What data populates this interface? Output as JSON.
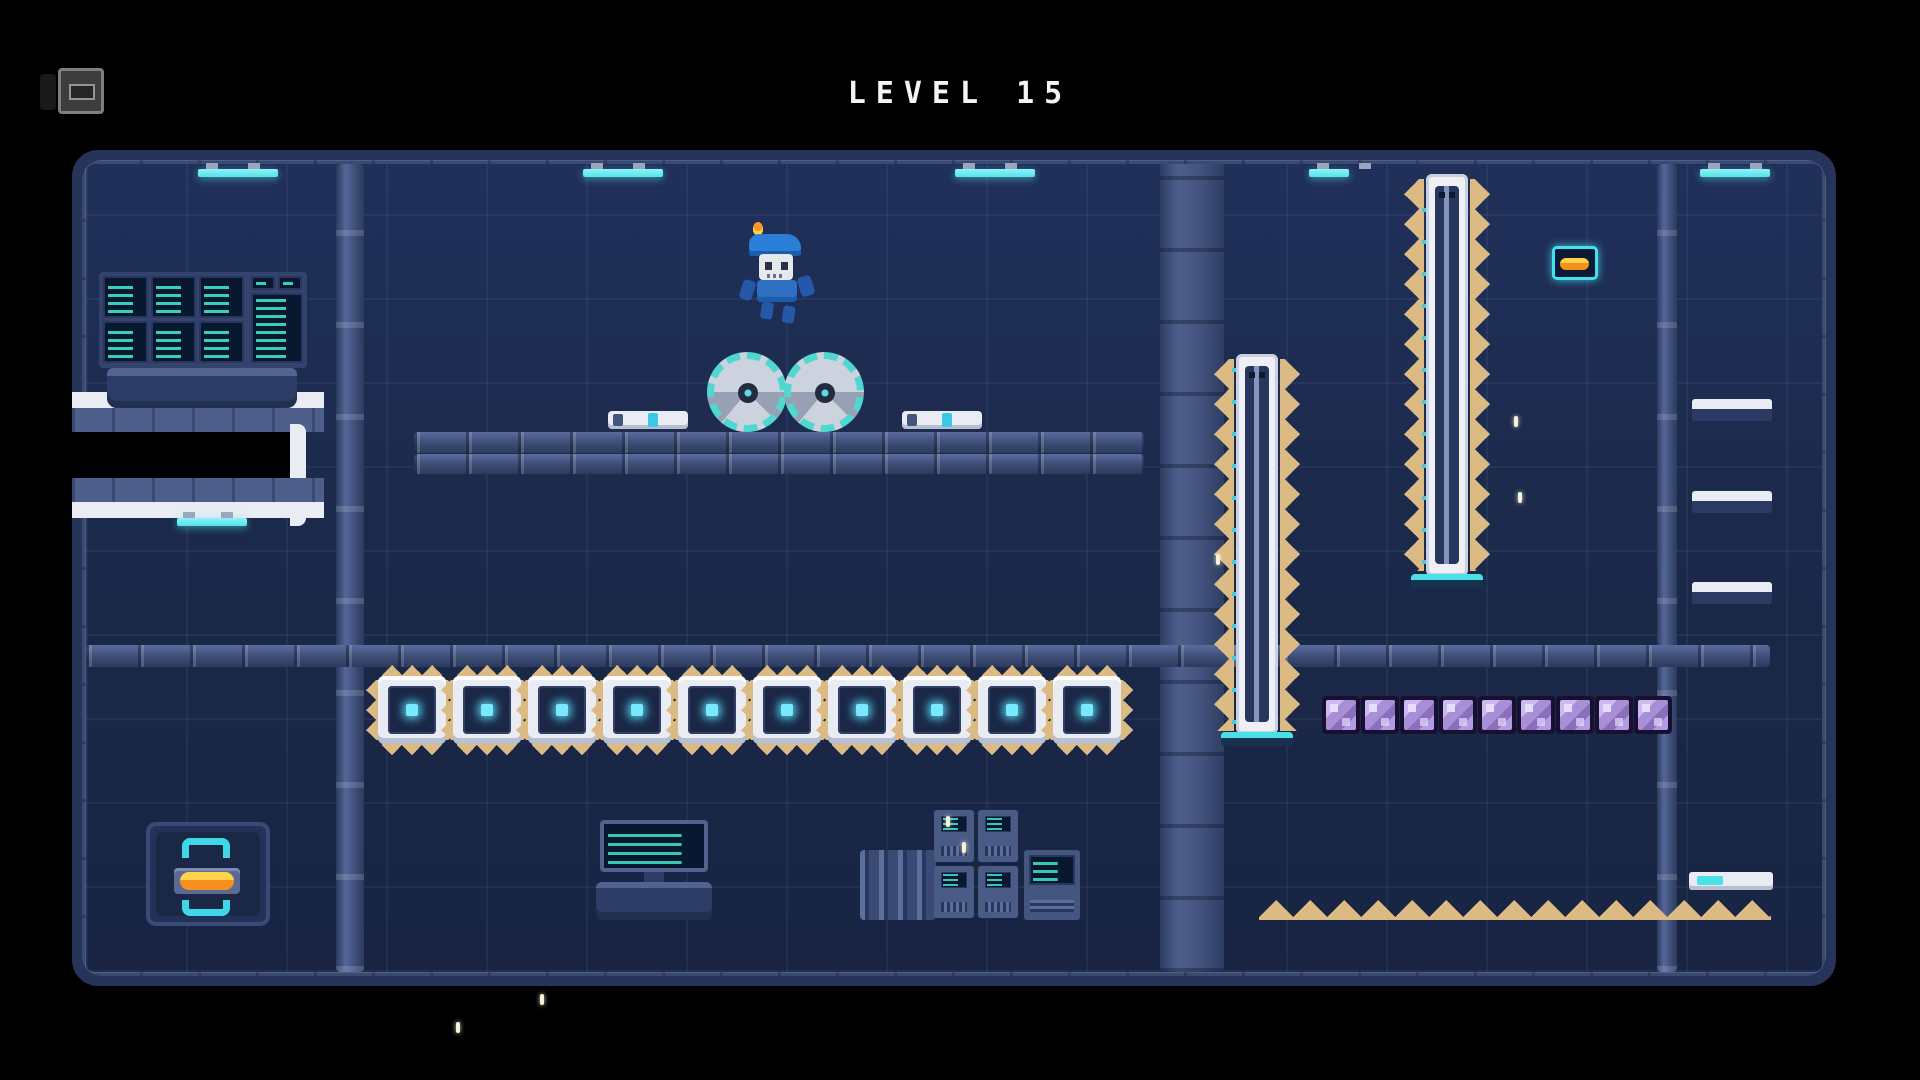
{
  "hud": {
    "menu_button": {
      "icon": "window-icon"
    }
  },
  "title": {
    "text": "LEVEL 15"
  },
  "room": {
    "entities": {
      "player": {
        "sprite": "skeleton-astronaut-blue",
        "state": "jumping"
      },
      "saw_blades": {
        "count": 2
      },
      "spike_blocks": {
        "count": 10
      },
      "crystal_blocks": {
        "count": 9
      },
      "spike_pillars": {
        "count": 2
      },
      "ceiling_lamps": {
        "count": 5
      },
      "wall_ledges": {
        "count": 3
      },
      "drone_platforms": {
        "count": 2
      },
      "floor_spike_clusters": {
        "count": 15
      },
      "battery_pickup": {
        "count": 1
      },
      "battery_dock": {
        "count": 1
      },
      "monitor_screens_small": {
        "count": 6
      },
      "server_boxes": {
        "count": 4
      }
    },
    "colors": {
      "outside": "#000000",
      "wall": "#1c2a4b",
      "frame": "#4d5f8a",
      "border_white": "#e9ecf2",
      "spike_tan": "#dcba84",
      "crystal_purple": "#ab92dc",
      "lamp_teal": "#52e4ea",
      "battery_orange": "#f5901e",
      "core_cyan": "#54d8f0",
      "screen_text_teal": "#3dd9c0",
      "saw_teeth_teal": "#4fd8d0",
      "player_blue": "#2b7fd8"
    }
  }
}
